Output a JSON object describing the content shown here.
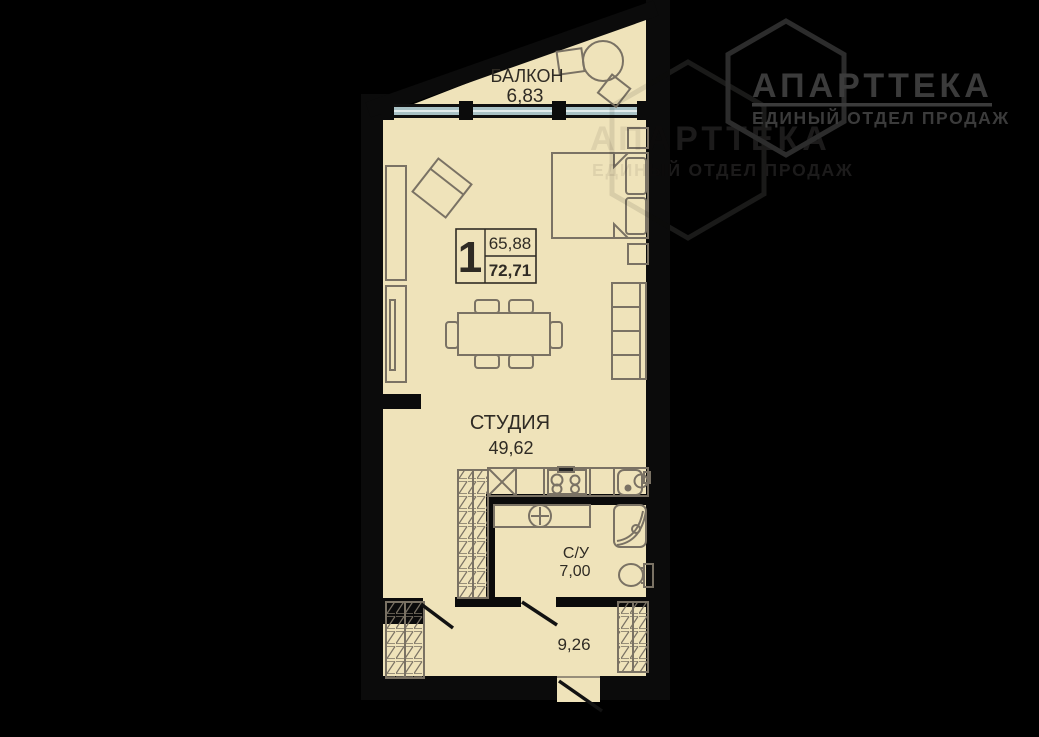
{
  "logo": {
    "title": "АПАРТТЕКА",
    "subtitle": "ЕДИНЫЙ ОТДЕЛ ПРОДАЖ"
  },
  "watermark": {
    "title": "АПАРТТЕКА",
    "subtitle": "ЕДИНЫЙ ОТДЕЛ ПРОДАЖ"
  },
  "floor_plan": {
    "unit_info": {
      "number": "1",
      "area_living": "65,88",
      "area_total": "72,71"
    },
    "rooms": {
      "balcony": {
        "label": "БАЛКОН",
        "area": "6,83"
      },
      "studio": {
        "label": "СТУДИЯ",
        "area": "49,62"
      },
      "bathroom": {
        "label": "С/У",
        "area": "7,00"
      },
      "hallway": {
        "label": "",
        "area": "9,26"
      }
    }
  },
  "colors": {
    "background": "#000000",
    "floor": "#efe3ba",
    "walls": "#0b0b0b",
    "window_glass": "#a9c2c6",
    "furniture_outline": "#7a7264",
    "plan_text": "#2f2b24",
    "logo_gray": "#3b3b3b",
    "watermark_gray": "#1d1d1d"
  }
}
